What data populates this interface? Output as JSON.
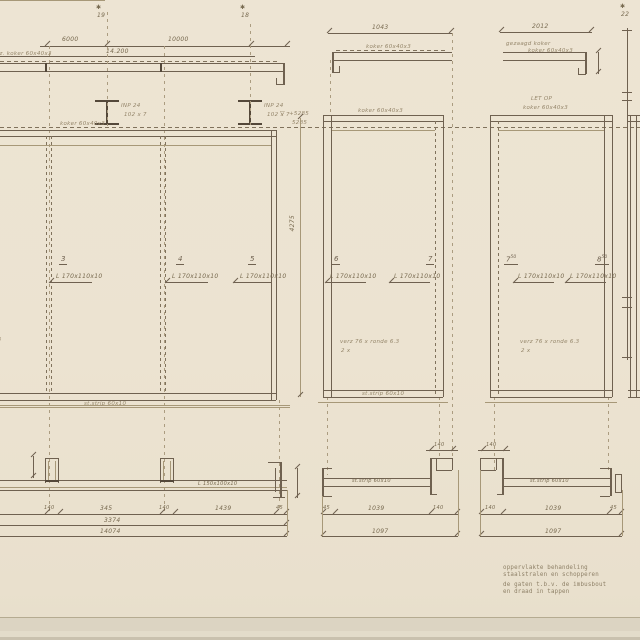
{
  "colors": {
    "paper": "#ece3d1",
    "ink": "#6f6150",
    "pencil": "#95866a",
    "edge_strip": "#dcd4c2"
  },
  "top": {
    "left": {
      "mark_star_a": "✱",
      "mark_num_a": "19",
      "mark_star_b": "✱",
      "mark_num_b": "18",
      "dim_span_a": "6000",
      "dim_span_b": "10000",
      "dim_total": "14.200",
      "beam_note": "gez. koker 60x40x3"
    },
    "middle": {
      "dim": "1043",
      "beam_note": "koker 60x40x3"
    },
    "right": {
      "dim": "2012",
      "beam_note_1": "gezaagd koker",
      "beam_note_2": "koker 60x40x3",
      "mark_star": "✱",
      "mark_num": "22"
    }
  },
  "profiles": {
    "ibeam_label_1a": "INP 24",
    "ibeam_label_1b": "102 x 7",
    "ibeam_label_2a": "INP 24",
    "ibeam_label_2b": "102 x 7",
    "level_mark": "▽",
    "level_value_1": "+5285",
    "level_value_2": "5285"
  },
  "elevation": {
    "left": {
      "num_3": "3",
      "num_4": "4",
      "num_5": "5",
      "angle_note_3": "L 170x110x10",
      "angle_note_4": "L 170x110x10",
      "angle_note_5": "L 170x110x10",
      "edge_note": "verz 76 x ronde 6.3",
      "top_note": "koker 60x40x3",
      "strip_note": "st.strip 60x10"
    },
    "middle": {
      "num_6": "6",
      "num_7": "7",
      "angle_note_6": "L 170x110x10",
      "angle_note_7": "L 170x110x10",
      "weld_note": "verz 76 x ronde 6.3",
      "weld_qty": "2 x",
      "top_note": "koker 60x40x3",
      "strip_note": "st.strip 60x10",
      "height_dim": "4275"
    },
    "right": {
      "num_a": "7",
      "num_a_sup": "50",
      "num_b": "8",
      "num_b_sup": "50",
      "attention": "LET OP",
      "top_note": "koker 60x40x3",
      "angle_note_a": "L 170x110x10",
      "angle_note_b": "L 170x110x10",
      "weld_note": "verz 76 x ronde 6.3",
      "weld_qty": "2 x"
    }
  },
  "plan": {
    "left": {
      "bar_note": "L 150x100x10",
      "dim_140_a": "140",
      "dim_345": "345",
      "dim_140_b": "140",
      "dim_1439": "1439",
      "dim_45": "45",
      "total_a": "3374",
      "total_b": "14074"
    },
    "middle": {
      "bar_note": "st.strip 60x10",
      "dim_top": "140",
      "dim_45": "45",
      "dim_main": "1039",
      "dim_140": "140",
      "total": "1097"
    },
    "right": {
      "bar_note": "st.strip 60x10",
      "dim_top": "140",
      "dim_140": "140",
      "dim_main": "1039",
      "dim_45": "45",
      "total": "1097"
    }
  },
  "notes": {
    "line1": "oppervlakte behandeling",
    "line2": "staalstralen en schopperen",
    "line3": "de gaten t.b.v. de imbusbout",
    "line4": "en draad in tappen"
  }
}
